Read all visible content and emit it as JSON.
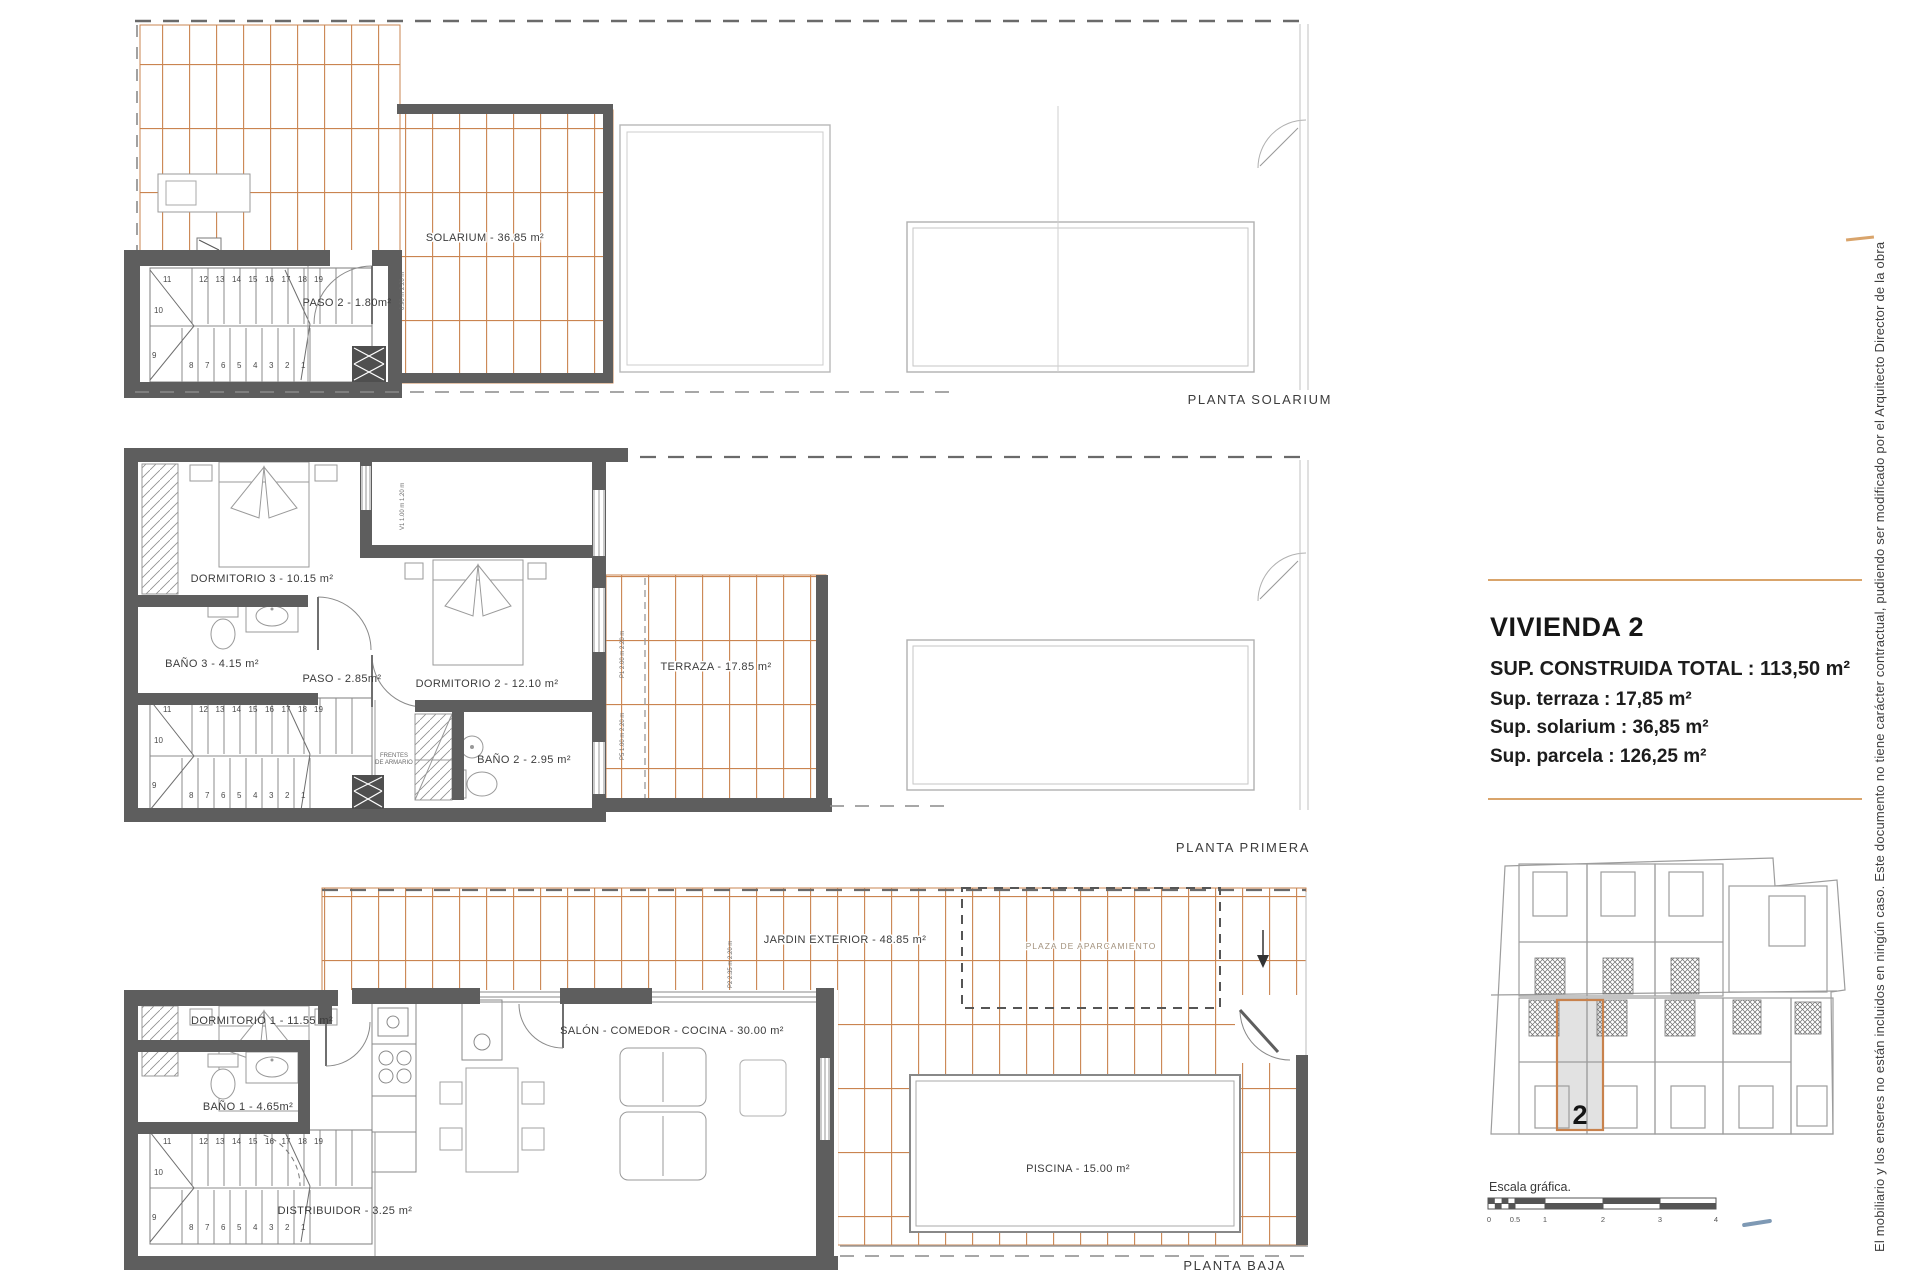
{
  "sidebar": {
    "title": "VIVIENDA 2",
    "spec1": "SUP. CONSTRUIDA TOTAL : 113,50 m²",
    "spec2": "Sup. terraza : 17,85 m²",
    "spec3": "Sup. solarium : 36,85 m²",
    "spec4": "Sup. parcela : 126,25 m²",
    "scale_label": "Escala gráfica.",
    "scale_ticks": [
      "0",
      "0.5",
      "1",
      "2",
      "3",
      "4"
    ],
    "unit_number": "2",
    "accent_color": "#d9a46b"
  },
  "side_note": "El mobiliario y los enseres no están incluidos en ningún caso. Este documento no tiene carácter contractual, pudiendo ser modificado por el Arquitecto Director de la obra",
  "plans": {
    "solarium": {
      "title": "PLANTA SOLARIUM",
      "solarium": "SOLARIUM - 36.85 m²",
      "paso2": "PASO 2 - 1.80m²",
      "door_note": "0.90 m 2.20 m"
    },
    "primera": {
      "title": "PLANTA PRIMERA",
      "dormitorio3": "DORMITORIO 3 - 10.15 m²",
      "bano3": "BAÑO 3 - 4.15 m²",
      "paso": "PASO - 2.85m²",
      "dormitorio2": "DORMITORIO 2 - 12.10 m²",
      "bano2": "BAÑO 2 - 2.95 m²",
      "terraza": "TERRAZA - 17.85 m²",
      "armario_l1": "FRENTES",
      "armario_l2": "DE ARMARIO",
      "v1": "V1 1.00 m 1.20 m",
      "p1": "P1 2.00 m 2.20 m",
      "p5": "P5 1.00 m 2.20 m"
    },
    "baja": {
      "title": "PLANTA BAJA",
      "dormitorio1": "DORMITORIO 1 - 11.55 m²",
      "bano1": "BAÑO 1 - 4.65m²",
      "distribuidor": "DISTRIBUIDOR - 3.25 m²",
      "salon": "SALÓN - COMEDOR - COCINA - 30.00 m²",
      "jardin": "JARDIN EXTERIOR - 48.85 m²",
      "piscina": "PISCINA - 15.00 m²",
      "plaza": "PLAZA DE APARCAMIENTO",
      "p2": "P2 2.35 m 2.20 m"
    }
  },
  "stairs": {
    "top": [
      "11",
      "12",
      "13",
      "14",
      "15",
      "16",
      "17",
      "18",
      "19"
    ],
    "bottom": [
      "8",
      "7",
      "6",
      "5",
      "4",
      "3",
      "2",
      "1"
    ],
    "left": [
      "10",
      "9"
    ]
  }
}
